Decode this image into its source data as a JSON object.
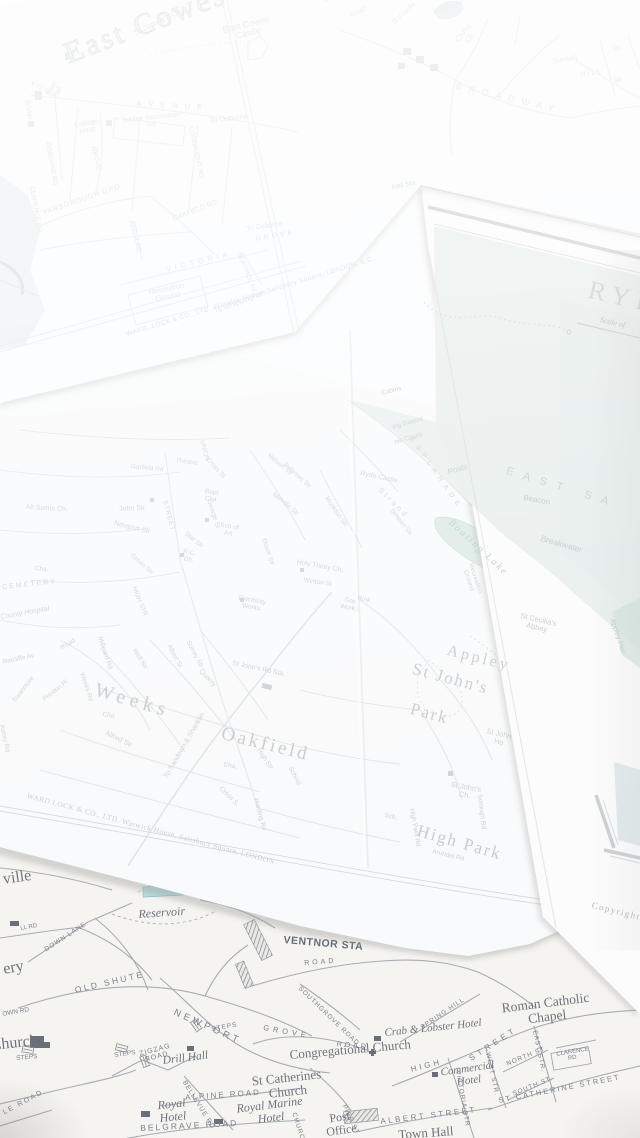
{
  "colors": {
    "paper_white": "#fbfcfd",
    "ventnor_paper": "#f5f4f1",
    "sea_tint": "#e7eeec",
    "reservoir_blue": "#b7dcdf",
    "faint_ink": "#cbd0d5",
    "ventnor_ink": "#7b818b"
  },
  "east_cowes": {
    "title": "East Cowes",
    "st_james": "St James's Ch",
    "castle": "East Cowes Castle",
    "york": "YORK",
    "avenue": "AVENUE",
    "town_hall": "Town Hall",
    "cottage_hosp": "Cottage Hosp",
    "jubilee": "Jubilee Recreation Gd",
    "to_osborne": "To Osborne",
    "to_osborne2": "To Osborne",
    "osborne_rd": "OSBORNE RD",
    "road": "ROAD",
    "grove_v": "GROVE",
    "connaught": "CONNAUGHT RD",
    "yarborough": "YARBOROUGH GRO.",
    "oakfield_rd": "OAKFIELD RD",
    "grove": "GROVE",
    "adela": "ADELA RD",
    "victoria": "VICTORIA",
    "beatrice": "BEATRICE AV",
    "clarence": "CLARENCE RD",
    "recreation": "Recreation Ground",
    "whippingham": "To Whippingham",
    "imprint": "WARD, LOCK & CO., LTD. Warwick House, Salisbury Square, LONDON, E.C."
  },
  "sandown": {
    "reservoir": "Reservoir",
    "barracks": "Barracks",
    "road": "Road",
    "newcomen": "Newcomen Rd",
    "christ_ch": "Christ Ch",
    "broadway": "BROADWAY",
    "nunwell": "Nunwell",
    "str1": "Str.",
    "hill": "HILL",
    "str2": "Str.",
    "sta": "ead Sta."
  },
  "ryde_cover": {
    "title": "RYDE",
    "scale": "Scale of",
    "copyright": "Copyright",
    "east_sands": "EAST SA",
    "beacon": "Beacon",
    "breakwater": "Breakwater",
    "posts": "Posts",
    "boating_lake": "Boating Lake",
    "appley_pier": "Appley Pier",
    "st_cecilias": "St Cecilia's Abbey",
    "appley_big": "Appley"
  },
  "ryde": {
    "weeks": "Weeks",
    "oakfield": "Oakfield",
    "st_johns": "St John's",
    "park": "Park",
    "high_park": "High Park",
    "appley_sm": "Appley",
    "st_johns_ho": "St John's Ho.",
    "st_johns_ch": "St John's Ch.",
    "high_park_rd": "High Park Rd",
    "arundel": "Arundel Rd",
    "borough": "borough Rd",
    "sch": "Sch.",
    "st_johns_sta": "St John's Rd Sta.",
    "quarry": "Quarry",
    "high_str": "High Str",
    "school": "School",
    "cross_s": "Cross S.",
    "harding": "Harding Rd",
    "cha1": "Cha.",
    "cha2": "Cha.",
    "cha3": "Cha.",
    "alfred": "Alfred Str",
    "millward": "Millward Rd",
    "weeks_rd": "Weeks Rd",
    "well": "Well Str",
    "albert": "Albert St",
    "surrey": "Surrey Str",
    "to_sandown": "To Sandown & Shanklin",
    "swanmore": "Swanmore",
    "road_sw": "Road",
    "ratcliffe": "Ratcliffe Av",
    "preston": "Preston Pl",
    "ashey": "Ashey Rd",
    "cemetery": "CEMETERY",
    "county_hosp": "County Hospital",
    "all_saints": "All Saints Ch.",
    "john_str": "John Str",
    "newport": "Newport Str",
    "garfield": "Garfield Rd",
    "theatre": "Theatre",
    "cross_st": "Cross St",
    "union": "UNION",
    "street": "STREET",
    "george": "George St",
    "star": "Star Str",
    "bapt": "Bapt Cha",
    "rc_ch": "R.C. Ch.",
    "sch_art": "Sch of Art",
    "green": "Green Str",
    "high": "HIGH STR",
    "holy_trinity": "Holy Trinity Ch.",
    "winton": "Winton St",
    "electricity": "Electricity Works",
    "gas": "Gas Works",
    "rink": "Rink",
    "recreation": "Recreation Ground",
    "melville": "Melville Str",
    "nelson": "Nelson Str",
    "bellevue": "Bellevue Str",
    "dover": "Dover Str",
    "monkton": "Monkton Str",
    "ryde_castle": "Ryde Castle",
    "strand": "Strand",
    "simeon": "Simeon Str",
    "esplanade": "ESPLANADE",
    "cabins": "Cabins",
    "greens": "ing Greens",
    "courts": "nis Courts",
    "imprint": "WARD LOCK & CO., LTD. Warwick House, Salisbury Square, LONDON."
  },
  "ventnor": {
    "ville": "ville",
    "reservoir": "Reservoir",
    "down_lane": "DOWN LANE",
    "ll_rd": "LL RD",
    "ery": "ery",
    "old_shute": "OLD SHUTE",
    "own_rd": "OWN RD",
    "newport": "NEWPORT",
    "steps1": "STEPS",
    "steps2": "STEPS",
    "steps3": "STEPS",
    "station": "VENTNOR STA",
    "road": "ROAD",
    "southgrove": "SOUTHGROVE ROAD",
    "spring_hill": "SPRING HILL",
    "roman_catholic": "Roman Catholic Chapel",
    "crab": "Crab & Lobster Hotel",
    "grove": "GROVE",
    "road2": "ROAD",
    "church_left": "Church",
    "zigzag": "ZIGZAG ROAD",
    "drill_hall": "Drill Hall",
    "bellevue": "BELLEVUE RD",
    "alpine": "ALPINE ROAD",
    "royal": "Royal Hotel",
    "royal_marine": "Royal Marine Hotel",
    "belgrave": "BELGRAVE ROAD",
    "le_road": "LE ROAD",
    "st_catherines": "St Catherines Church",
    "congregational": "Congregational Church",
    "high": "HIGH",
    "street": "STREET",
    "commercial": "Commercial Hotel",
    "victoria": "VICTORIA STR",
    "west": "WEST STR.",
    "north": "NORTH ST",
    "south": "SOUTH ST.",
    "east": "EAST STR.",
    "clarence": "CLARENCE RD",
    "st_catherine_st": "ST CATHERINE STREET",
    "albert": "ALBERT STREET",
    "town_hall": "Town Hall",
    "post_office": "Post Office",
    "pier": "PIER ST",
    "church_st": "CHURCH ST"
  }
}
